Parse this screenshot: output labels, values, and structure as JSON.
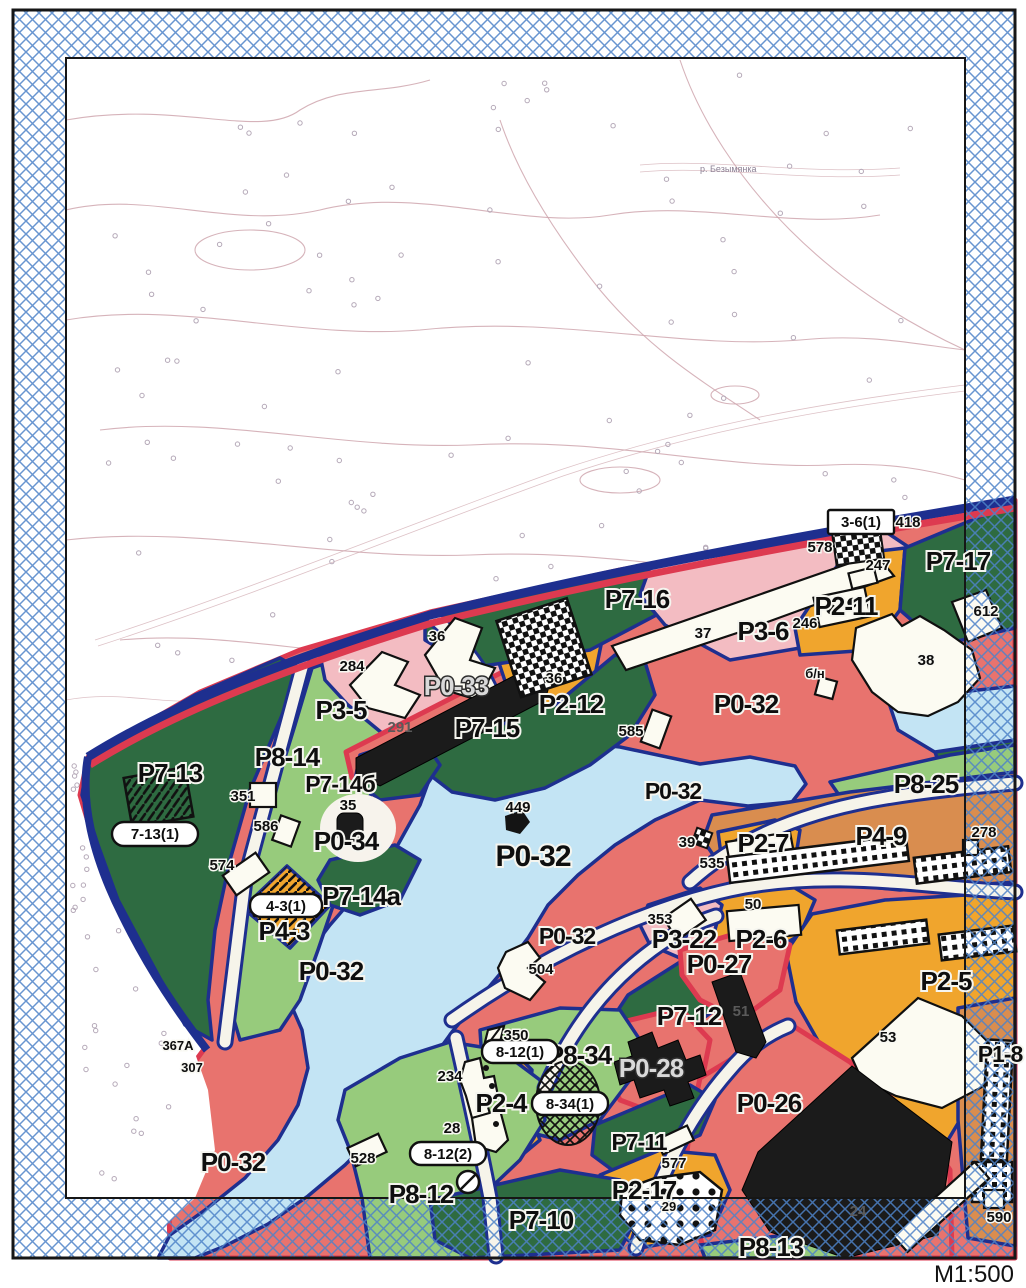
{
  "map": {
    "scale_label": "М1:500",
    "topo": {
      "river_label": "р. Безымянка"
    },
    "zone_labels": {
      "p7_13": "Р7-13",
      "p8_14": "Р8-14",
      "p3_5": "Р3-5",
      "p0_33": "Р0-33",
      "p7_14b": "Р7-14б",
      "p7_15": "Р7-15",
      "p2_12": "Р2-12",
      "p7_16": "Р7-16",
      "p3_6": "Р3-6",
      "p2_11": "Р2-11",
      "p7_17": "Р7-17",
      "p0_32": "Р0-32",
      "p0_34": "Р0-34",
      "p7_14a": "Р7-14а",
      "p4_3": "Р4-3",
      "p8_25": "Р8-25",
      "p4_9": "Р4-9",
      "p2_7": "Р2-7",
      "p2_6": "Р2-6",
      "p3_22": "Р3-22",
      "p0_27": "Р0-27",
      "p2_5": "Р2-5",
      "p7_12": "Р7-12",
      "p8_34": "Р8-34",
      "p2_4": "Р2-4",
      "p0_28": "Р0-28",
      "p0_26": "Р0-26",
      "p7_11": "Р7-11",
      "p8_12": "Р8-12",
      "p7_10": "Р7-10",
      "p2_17": "Р2-17",
      "p8_13": "Р8-13",
      "p1_8": "Р1-8"
    },
    "badge_labels": {
      "b7_13_1": "7-13(1)",
      "b4_3_1": "4-3(1)",
      "b8_12_1": "8-12(1)",
      "b8_12_2": "8-12(2)",
      "b8_34_1": "8-34(1)",
      "b3_6_1": "3-6(1)"
    },
    "building_numbers": {
      "n284": "284",
      "n36": "36",
      "n37": "37",
      "n38": "38",
      "n585": "585",
      "n351": "351",
      "n586": "586",
      "n574": "574",
      "n35": "35",
      "n449": "449",
      "n39": "39",
      "n535": "535",
      "n278": "278",
      "n50": "50",
      "n353": "353",
      "n504": "504",
      "n350": "350",
      "n234": "234",
      "n28": "28",
      "n577": "577",
      "n528": "528",
      "n590": "590",
      "n612": "612",
      "n418": "418",
      "n578": "578",
      "n247": "247",
      "n246": "246",
      "n53": "53",
      "n367a": "367А",
      "n307": "307",
      "nbn": "б/н",
      "n291": "291",
      "n51": "51",
      "n24": "24",
      "n29": "29"
    },
    "colors": {
      "dark_green": "#2e6b41",
      "light_green": "#97cb7c",
      "salmon": "#e8736e",
      "pink": "#f3bcc2",
      "orange": "#f0a52d",
      "tan": "#d98d4f",
      "water": "#c3e4f4",
      "navy": "#1e2f8f",
      "crimson": "#dd3a50",
      "hatch_blue": "#4d82c8"
    }
  }
}
